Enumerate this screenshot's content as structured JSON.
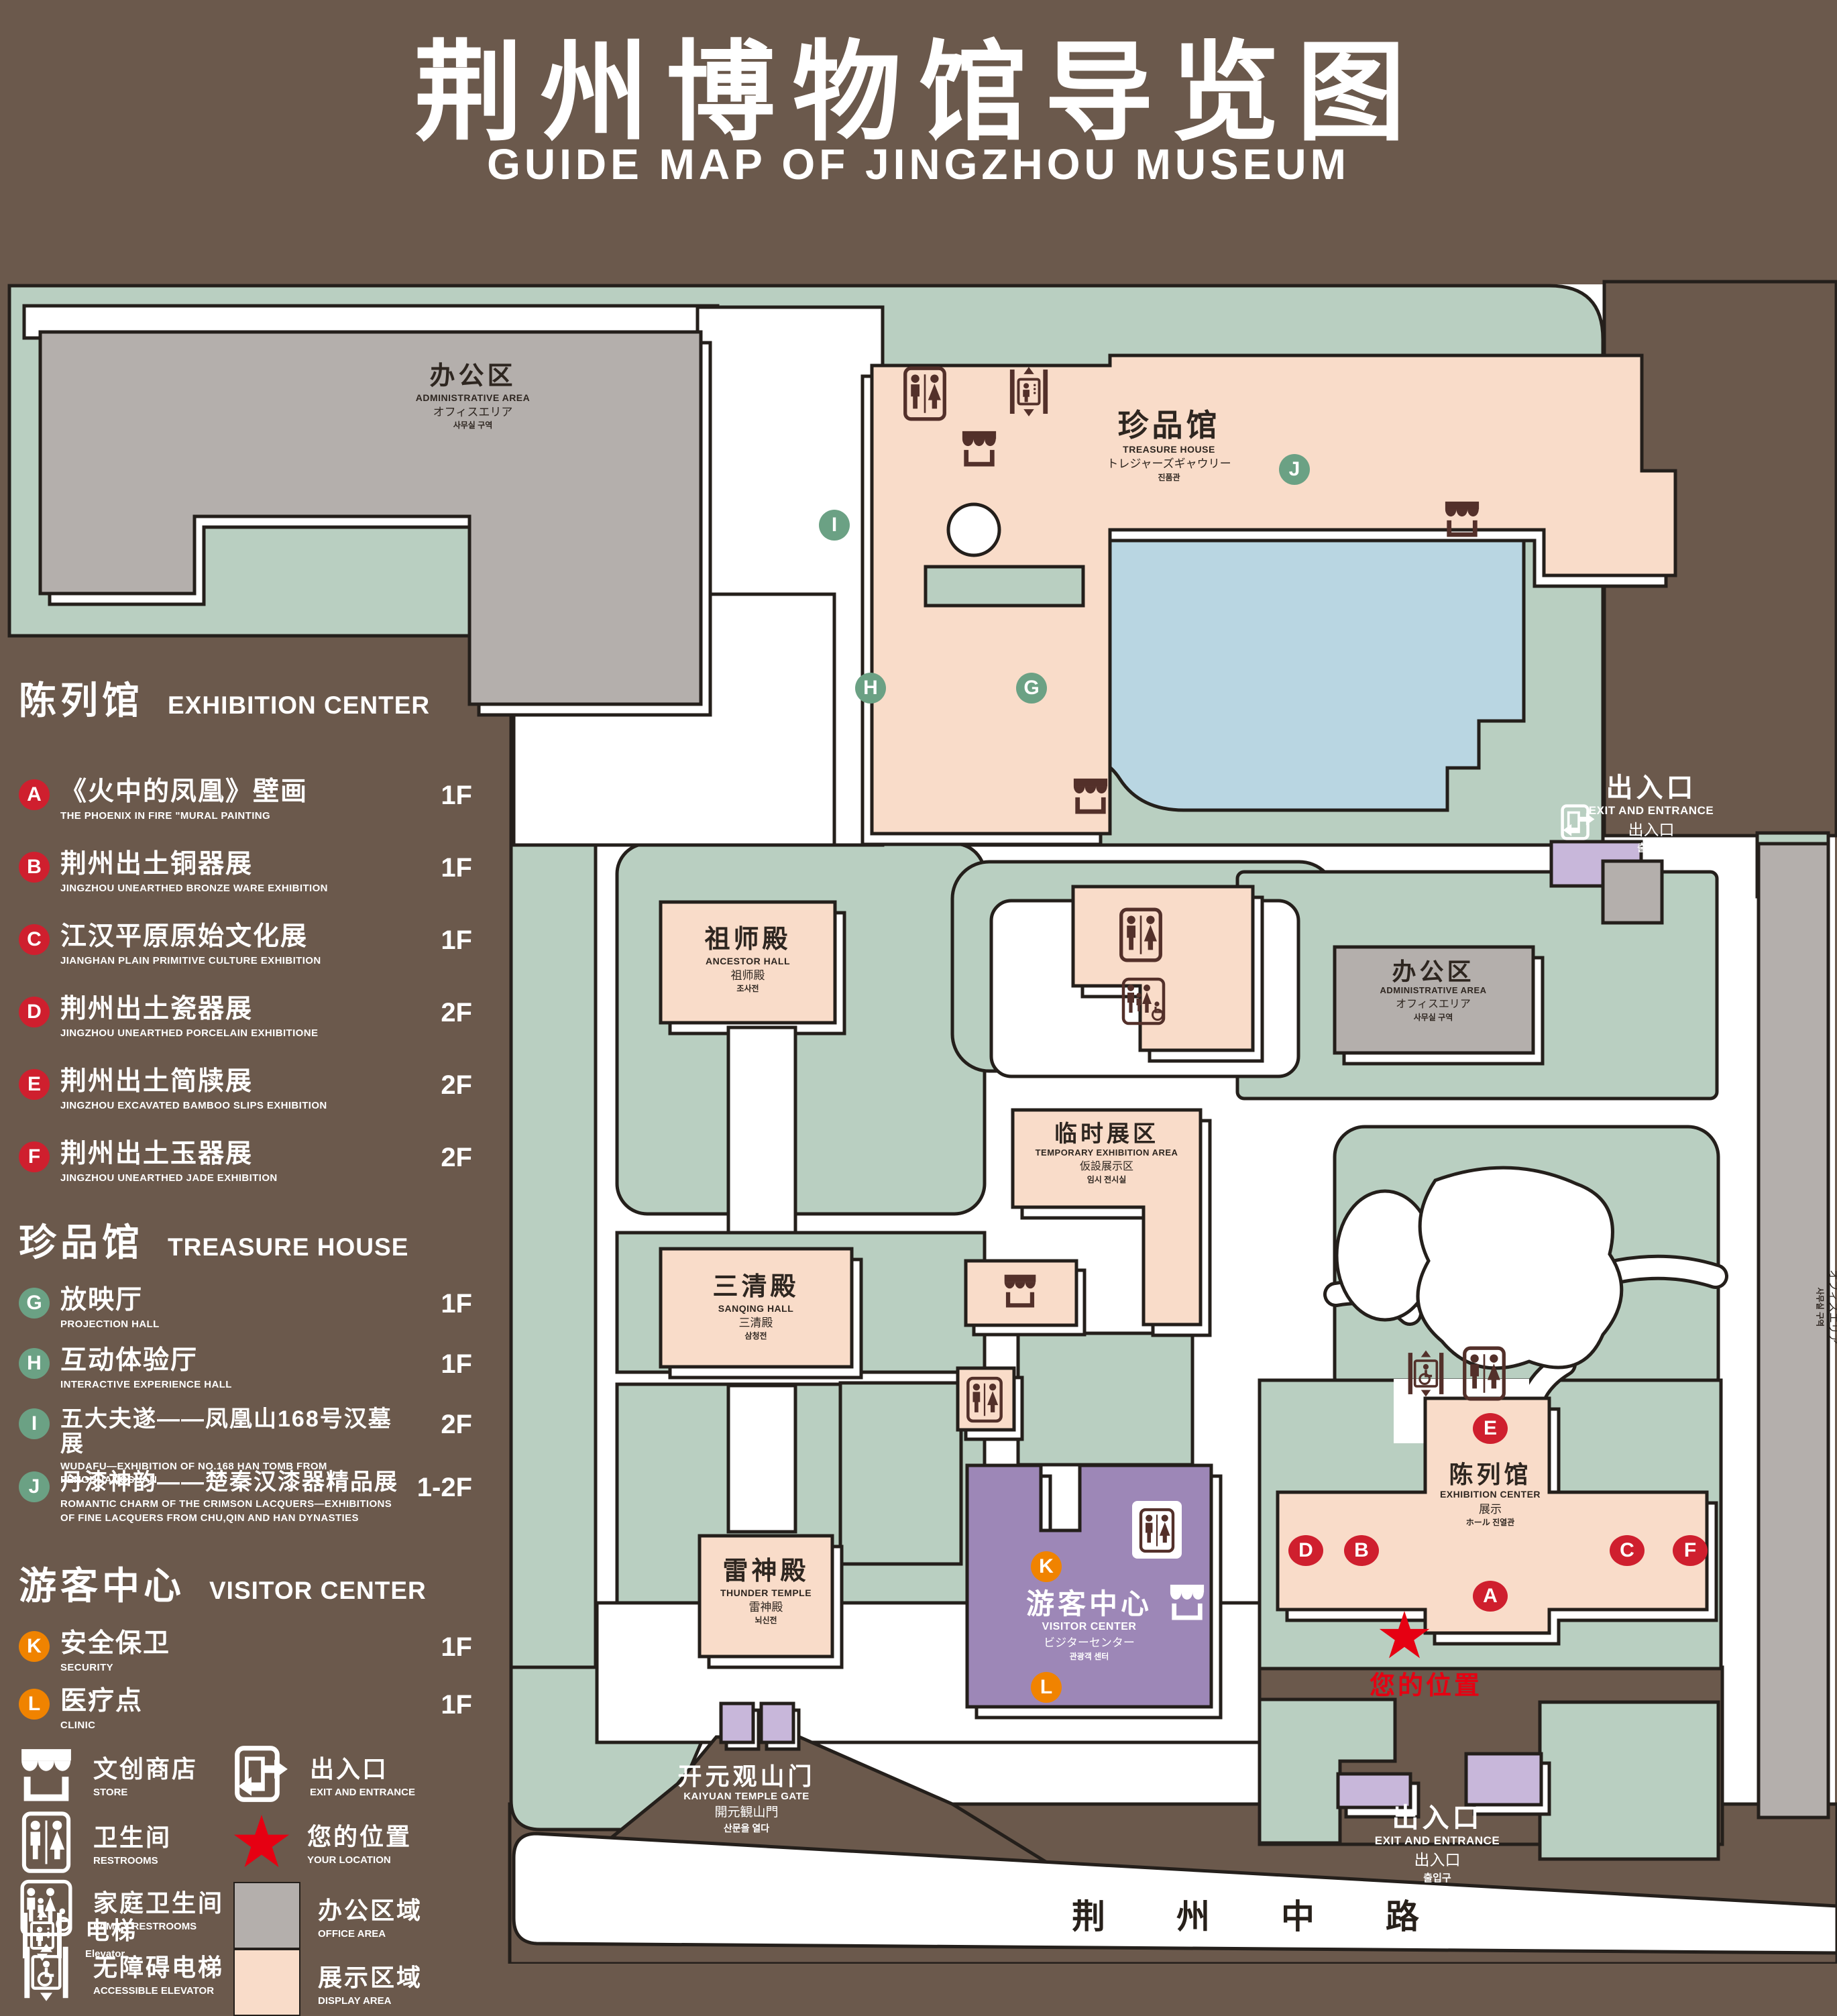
{
  "title": {
    "zh": "荆州博物馆导览图",
    "en": "GUIDE MAP OF JINGZHOU MUSEUM"
  },
  "colors": {
    "background_brown": "#6b594c",
    "park_green": "#b9cfc1",
    "display_area_peach": "#f9dcc9",
    "office_area_gray": "#b4afac",
    "water_blue": "#b9d6e2",
    "visitor_purple": "#9d87b7",
    "gate_lavender": "#c8b7da",
    "badge_red": "#cf1f2e",
    "badge_green": "#6ba184",
    "badge_orange": "#f08300",
    "location_red": "#e60012"
  },
  "legend": {
    "sections": [
      {
        "zh": "陈列馆",
        "en": "EXHIBITION CENTER",
        "items": [
          {
            "letter": "A",
            "zh": "《火中的凤凰》壁画",
            "en": "THE PHOENIX IN FIRE \"MURAL PAINTING",
            "floor": "1F"
          },
          {
            "letter": "B",
            "zh": "荆州出土铜器展",
            "en": "JINGZHOU UNEARTHED BRONZE WARE EXHIBITION",
            "floor": "1F"
          },
          {
            "letter": "C",
            "zh": "江汉平原原始文化展",
            "en": "JIANGHAN PLAIN PRIMITIVE CULTURE EXHIBITION",
            "floor": "1F"
          },
          {
            "letter": "D",
            "zh": "荆州出土瓷器展",
            "en": "JINGZHOU UNEARTHED PORCELAIN EXHIBITIONE",
            "floor": "2F"
          },
          {
            "letter": "E",
            "zh": "荆州出土简牍展",
            "en": "JINGZHOU EXCAVATED BAMBOO SLIPS EXHIBITION",
            "floor": "2F"
          },
          {
            "letter": "F",
            "zh": "荆州出土玉器展",
            "en": "JINGZHOU UNEARTHED JADE EXHIBITION",
            "floor": "2F"
          }
        ]
      },
      {
        "zh": "珍品馆",
        "en": "TREASURE HOUSE",
        "items": [
          {
            "letter": "G",
            "zh": "放映厅",
            "en": "PROJECTION HALL",
            "floor": "1F"
          },
          {
            "letter": "H",
            "zh": "互动体验厅",
            "en": "INTERACTIVE EXPERIENCE HALL",
            "floor": "1F"
          },
          {
            "letter": "I",
            "zh": "五大夫遂——凤凰山168号汉墓展",
            "en": "WUDAFU—EXHIBITION OF NO.168 HAN TOMB FROM FENGHUANGSHAN",
            "floor": "2F"
          },
          {
            "letter": "J",
            "zh": "丹漆神韵——楚秦汉漆器精品展",
            "en": "ROMANTIC CHARM OF THE CRIMSON LACQUERS—EXHIBITIONS OF FINE LACQUERS FROM CHU,QIN AND HAN DYNASTIES",
            "floor": "1-2F"
          }
        ]
      },
      {
        "zh": "游客中心",
        "en": "VISITOR CENTER",
        "items": [
          {
            "letter": "K",
            "zh": "安全保卫",
            "en": "SECURITY",
            "floor": "1F"
          },
          {
            "letter": "L",
            "zh": "医疗点",
            "en": "CLINIC",
            "floor": "1F"
          }
        ]
      }
    ],
    "icons": {
      "left": [
        {
          "icon": "store-icon",
          "zh": "文创商店",
          "en": "STORE"
        },
        {
          "icon": "restrooms-icon",
          "zh": "卫生间",
          "en": "RESTROOMS"
        },
        {
          "icon": "family-restrooms-icon",
          "zh": "家庭卫生间",
          "en": "FAMILY RESTROOMS"
        },
        {
          "icon": "accessible-elevator-icon",
          "zh": "无障碍电梯",
          "en": "ACCESSIBLE ELEVATOR"
        },
        {
          "icon": "elevator-icon",
          "zh": "电梯",
          "en": "Elevator"
        }
      ],
      "right": [
        {
          "icon": "exit-icon",
          "zh": "出入口",
          "en": "EXIT AND ENTRANCE"
        },
        {
          "icon": "location-star",
          "zh": "您的位置",
          "en": "YOUR LOCATION"
        },
        {
          "icon": "office-swatch",
          "zh": "办公区域",
          "en": "OFFICE AREA"
        },
        {
          "icon": "display-swatch",
          "zh": "展示区域",
          "en": "DISPLAY AREA"
        }
      ]
    }
  },
  "map": {
    "buildings": {
      "admin": {
        "zh": "办公区",
        "en": "ADMINISTRATIVE AREA",
        "ja": "オフィスエリア",
        "ko": "사무실 구역"
      },
      "treasure_house": {
        "zh": "珍品馆",
        "en": "TREASURE HOUSE",
        "ja": "トレジャーズギャウリー",
        "ko": "진품관"
      },
      "ancestor_hall": {
        "zh": "祖师殿",
        "en": "ANCESTOR HALL",
        "ja": "祖师殿",
        "ko": "조사전"
      },
      "sanqing_hall": {
        "zh": "三清殿",
        "en": "SANQING HALL",
        "ja": "三清殿",
        "ko": "삼청전"
      },
      "thunder_temple": {
        "zh": "雷神殿",
        "en": "THUNDER TEMPLE",
        "ja": "雷神殿",
        "ko": "뇌신전"
      },
      "temporary_area": {
        "zh": "临时展区",
        "en": "TEMPORARY EXHIBITION AREA",
        "ja": "仮設展示区",
        "ko": "임시 전시실"
      },
      "visitor_center": {
        "zh": "游客中心",
        "en": "VISITOR CENTER",
        "ja": "ビジターセンター",
        "ko": "관광객 센터"
      },
      "exhibition_center": {
        "zh": "陈列馆",
        "en": "EXHIBITION CENTER",
        "ja": "展示",
        "ko": "ホール 진열관"
      }
    },
    "exit": {
      "zh": "出入口",
      "en": "EXIT AND ENTRANCE",
      "ja": "出入口",
      "ko": "출입구"
    },
    "gate": {
      "zh": "开元观山门",
      "en": "KAIYUAN TEMPLE GATE",
      "ja": "開元観山門",
      "ko": "산문을 열다"
    },
    "road": "荆 州 中 路",
    "your_location": "您的位置",
    "markers": {
      "red": [
        "A",
        "B",
        "C",
        "D",
        "E",
        "F"
      ],
      "green": [
        "G",
        "H",
        "I",
        "J"
      ],
      "orange": [
        "K",
        "L"
      ]
    }
  }
}
